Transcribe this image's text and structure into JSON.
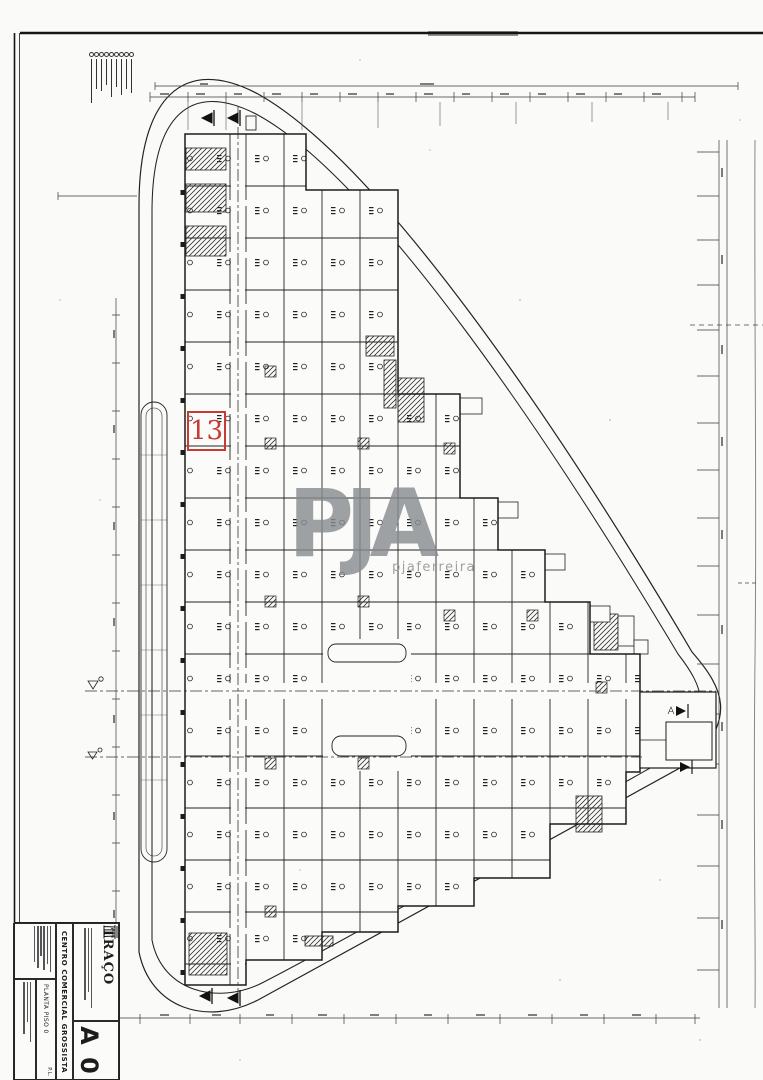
{
  "watermark": {
    "text": "PJA",
    "subtext": "pjaferreira",
    "color": "#878b8e"
  },
  "highlighted_unit": {
    "label": "13",
    "color": "#c63b33"
  },
  "title_block": {
    "firm_name": "TRAÇO",
    "project_title": "CENTRO COMERCIAL GROSSISTA",
    "drawing_title": "PLANTA PISO 0",
    "discipline_label": "P.L.",
    "sheet_code": "A 0"
  },
  "colors": {
    "ink": "#1d1d1d",
    "paper": "#fafaf8",
    "boundary": "#222222"
  }
}
